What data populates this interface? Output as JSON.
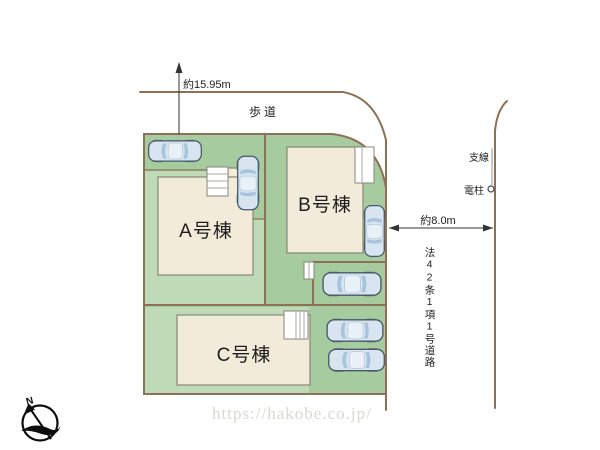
{
  "annotations": {
    "north_dimension": "約15.95m",
    "sidewalk": "歩道",
    "branch_line": "支線",
    "utility_pole": "電柱",
    "east_road_width": "約8.0m",
    "road_designation": "法42条1項1号道路",
    "compass_north": "N"
  },
  "buildings": [
    {
      "label": "A号棟"
    },
    {
      "label": "B号棟"
    },
    {
      "label": "C号棟"
    }
  ],
  "watermark": "https://hakobe.co.jp/",
  "colors": {
    "site_green": "#a5cb9e",
    "site_green_light": "#bedab6",
    "building_fill": "#f2ebd9",
    "building_outline": "#87877b",
    "boundary_brown": "#8d7156",
    "car_blue": "#d8e5f0",
    "watermark_gray": "#dbd7d1",
    "text_dark": "#1e1e1e"
  },
  "cars": [
    {
      "x": 148,
      "y": 139,
      "w": 54,
      "h": 24,
      "rot": 0
    },
    {
      "x": 236,
      "y": 152,
      "w": 24,
      "h": 62,
      "rot": 90
    },
    {
      "x": 362,
      "y": 205,
      "w": 25,
      "h": 52,
      "rot": 90
    },
    {
      "x": 318,
      "y": 271,
      "w": 68,
      "h": 26,
      "rot": 0
    },
    {
      "x": 324,
      "y": 318,
      "w": 62,
      "h": 25,
      "rot": 0
    },
    {
      "x": 328,
      "y": 347,
      "w": 57,
      "h": 26,
      "rot": 0
    }
  ]
}
